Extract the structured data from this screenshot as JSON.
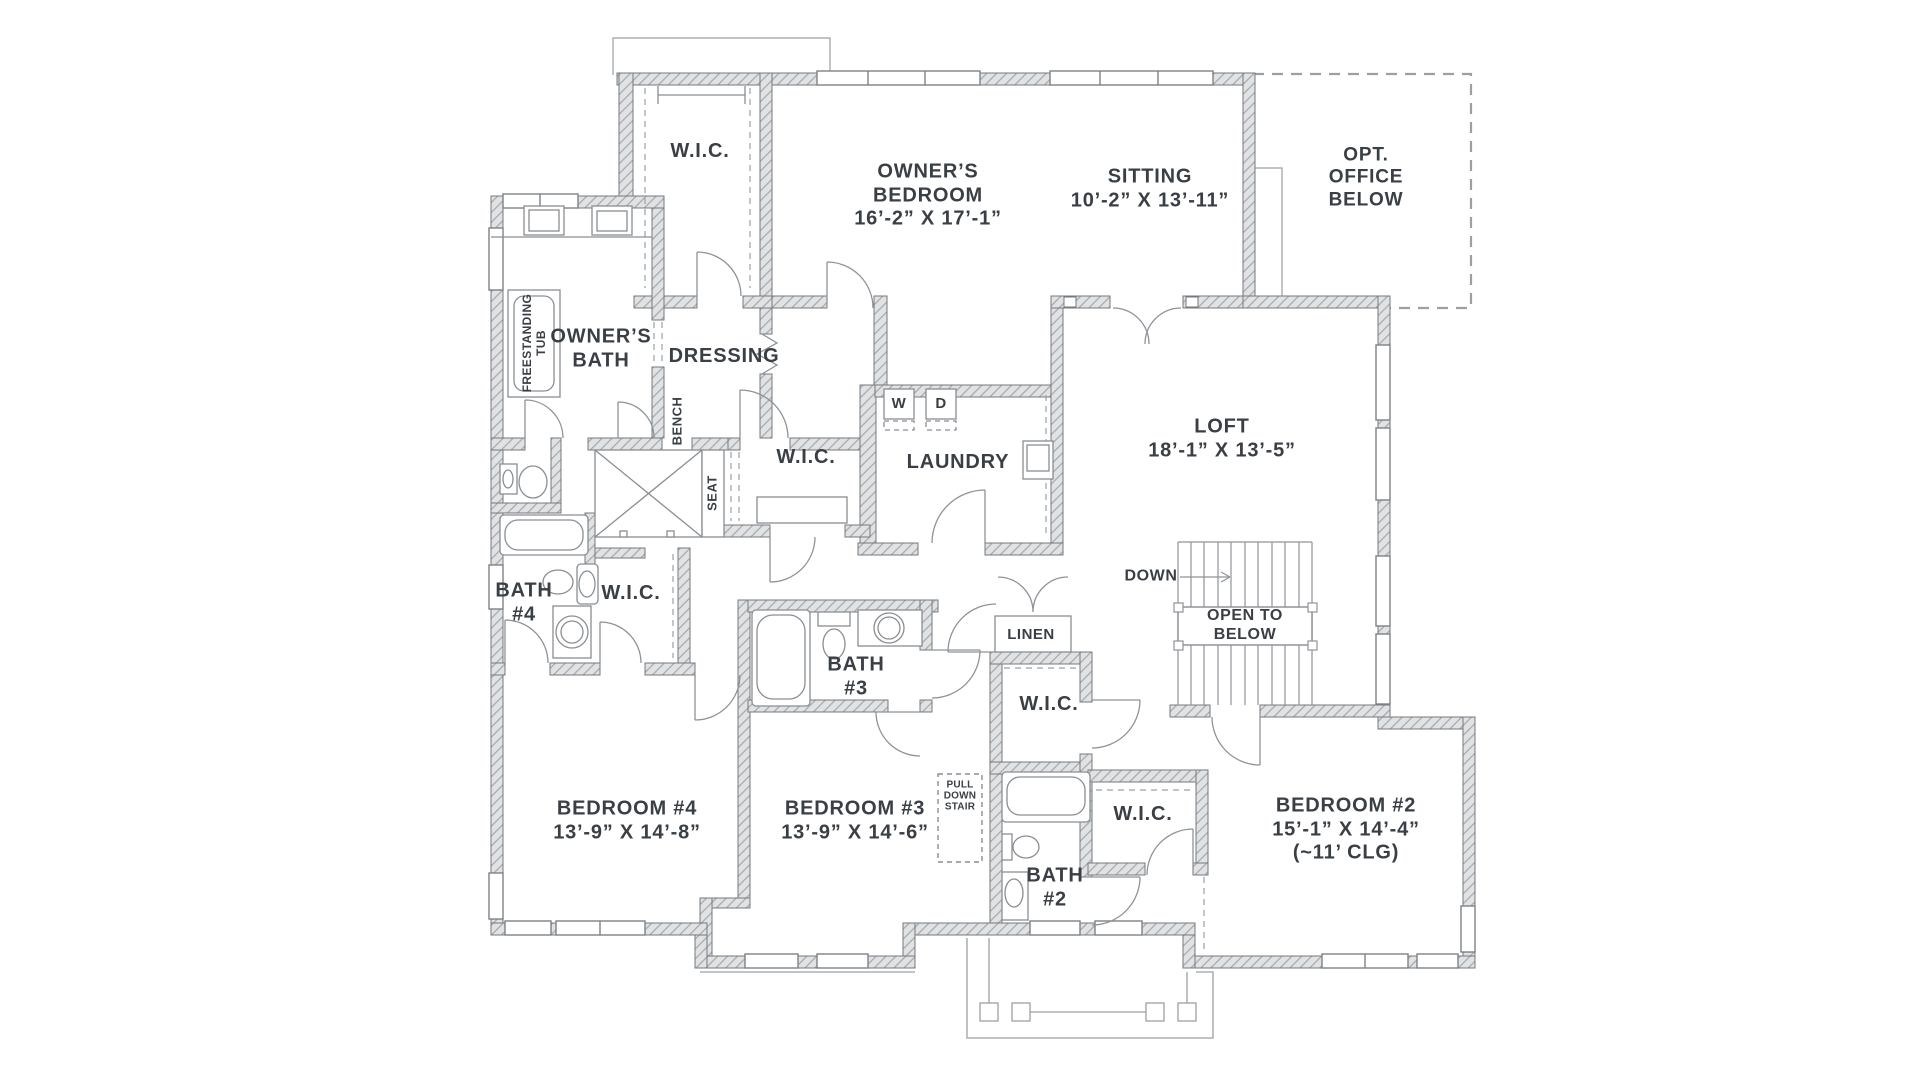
{
  "plan": {
    "type": "floor-plan",
    "floor": "second",
    "colors": {
      "background": "#ffffff",
      "wall_fill": "#e0e2e4",
      "wall_stripe": "#a4a8ab",
      "wall_outline": "#75797e",
      "thin_line": "#8a8e92",
      "text": "#3a3f45"
    }
  },
  "rooms": {
    "owner_closet": {
      "name": "W.I.C."
    },
    "owner_bedroom": {
      "line1": "OWNER’S",
      "line2": "BEDROOM",
      "dims": "16’-2” X 17’-1”"
    },
    "sitting": {
      "name": "SITTING",
      "dims": "10’-2” X 13’-11”"
    },
    "opt_office": {
      "line1": "OPT.",
      "line2": "OFFICE",
      "line3": "BELOW"
    },
    "owner_bath": {
      "line1": "OWNER’S",
      "line2": "BATH"
    },
    "freestanding_tub": {
      "line1": "FREESTANDING",
      "line2": "TUB"
    },
    "dressing": {
      "name": "DRESSING"
    },
    "bench": {
      "name": "BENCH"
    },
    "seat": {
      "name": "SEAT"
    },
    "wic_middle": {
      "name": "W.I.C."
    },
    "laundry": {
      "name": "LAUNDRY",
      "washer": "W",
      "dryer": "D"
    },
    "loft": {
      "name": "LOFT",
      "dims": "18’-1” X 13’-5”"
    },
    "stairs": {
      "down": "DOWN",
      "open1": "OPEN TO",
      "open2": "BELOW"
    },
    "bath4": {
      "line1": "BATH",
      "line2": "#4"
    },
    "wic_bath4": {
      "name": "W.I.C."
    },
    "linen": {
      "name": "LINEN"
    },
    "bath3": {
      "line1": "BATH",
      "line2": "#3"
    },
    "wic_bed3": {
      "name": "W.I.C."
    },
    "bedroom4": {
      "name": "BEDROOM #4",
      "dims": "13’-9” X 14’-8”"
    },
    "bedroom3": {
      "name": "BEDROOM #3",
      "dims": "13’-9” X 14’-6”"
    },
    "pull_down_stair": {
      "line1": "PULL",
      "line2": "DOWN",
      "line3": "STAIR"
    },
    "wic_bed2": {
      "name": "W.I.C."
    },
    "bath2": {
      "line1": "BATH",
      "line2": "#2"
    },
    "bedroom2": {
      "name": "BEDROOM #2",
      "dims": "15’-1” X 14’-4”",
      "ceiling": "(~11’ CLG)"
    }
  }
}
